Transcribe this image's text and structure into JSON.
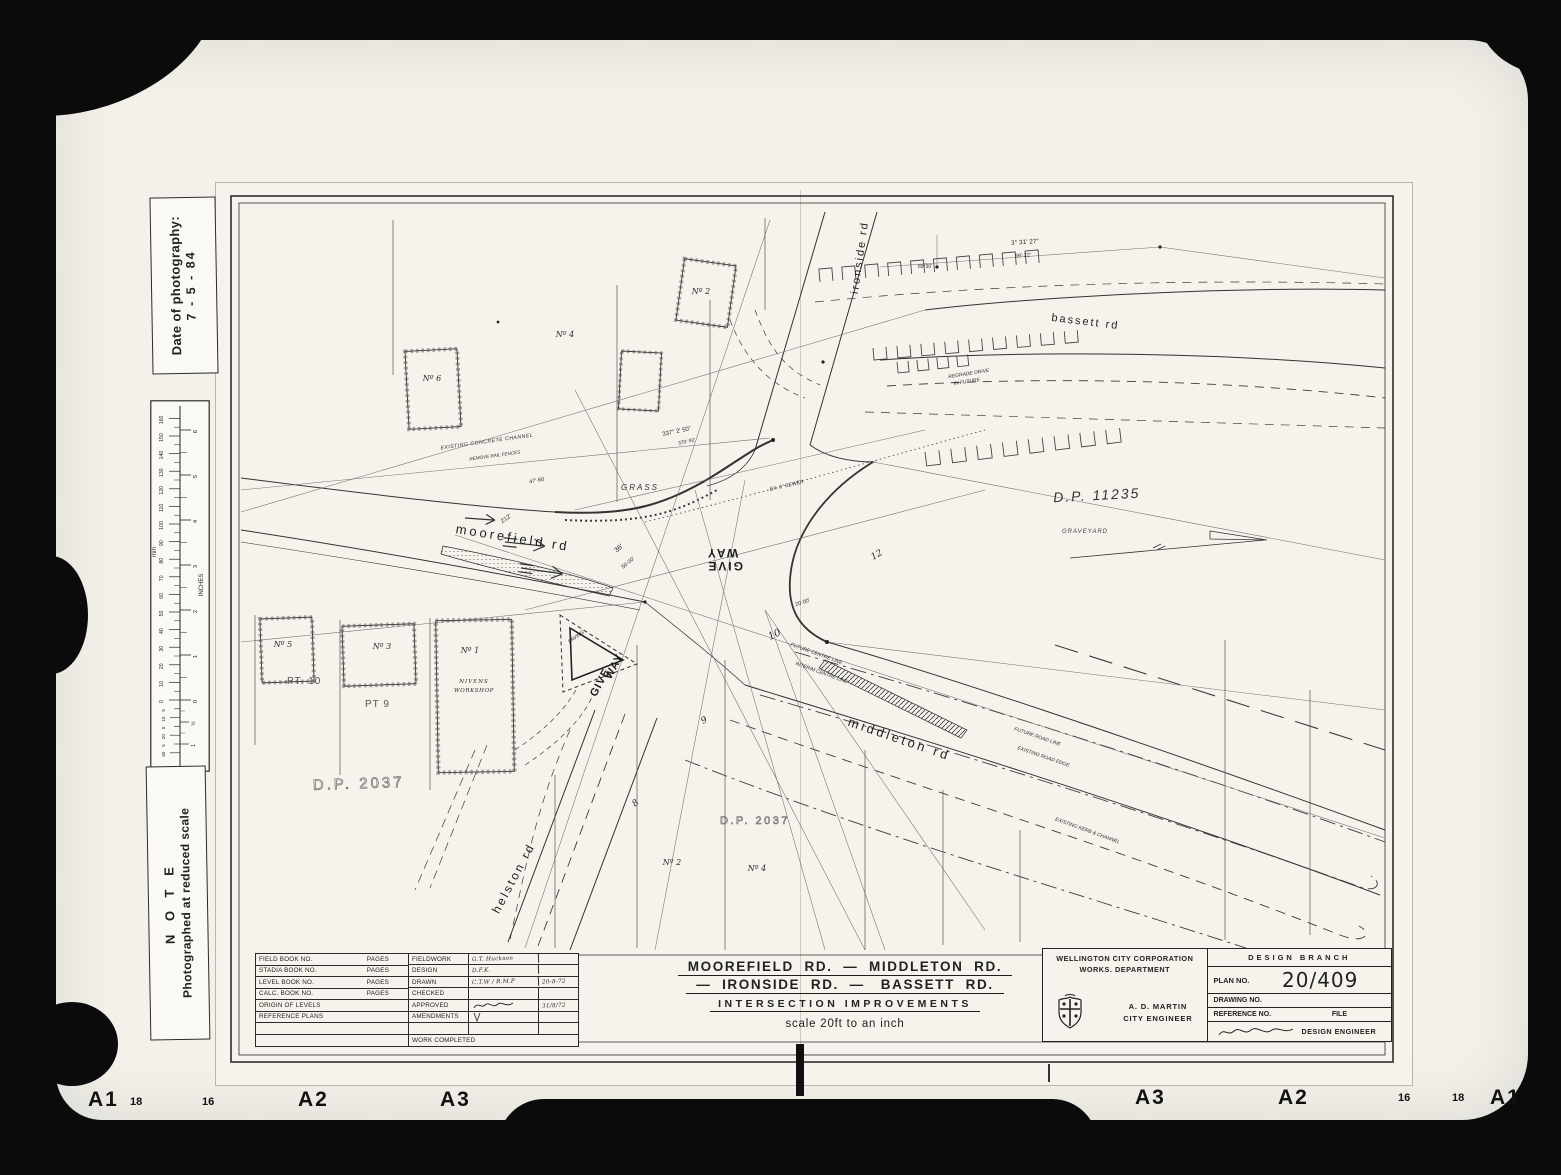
{
  "film": {
    "markers_left": [
      "A1",
      "18",
      "16",
      "A2",
      "A3"
    ],
    "markers_right": [
      "A3",
      "A2",
      "16",
      "18",
      "A1"
    ]
  },
  "side": {
    "date_label": "Date of photography:",
    "date_value": "7 - 5 - 84",
    "note_title": "N O T E",
    "note_text": "Photographed at reduced scale",
    "ruler_mm_label": "mm",
    "ruler_in_label": "INCHES",
    "mm": [
      "160",
      "150",
      "140",
      "130",
      "120",
      "110",
      "100",
      "90",
      "80",
      "70",
      "60",
      "50",
      "40",
      "30",
      "20",
      "10",
      "0"
    ],
    "mm_sub": [
      "5",
      "10",
      "5",
      "20",
      "5",
      "30"
    ],
    "inches": [
      "6",
      "5",
      "4",
      "3",
      "2",
      "1",
      "0"
    ],
    "inches_sub": [
      "½",
      "1"
    ]
  },
  "map": {
    "roads": {
      "moorefield": "moorefield  rd",
      "middleton": "middleton  rd",
      "helston": "helston  rd",
      "ironside": "ironside  rd",
      "bassett": "bassett  rd"
    },
    "areas": {
      "dp11235": "D.P. 11235",
      "dp2037_left": "D.P. 2037",
      "dp2037_mid": "D.P. 2037",
      "grass": "GRASS",
      "graveyard": "GRAVEYARD"
    },
    "lots": {
      "no1": "Nº 1",
      "no2_top": "Nº 2",
      "no3": "Nº 3",
      "no4_top": "Nº 4",
      "no5": "Nº 5",
      "no6": "Nº 6",
      "no2_bot": "Nº 2",
      "no4_bot": "Nº 4",
      "pt10": "PT. 10",
      "pt9": "PT 9",
      "n8": "8",
      "n9": "9",
      "n10": "10",
      "n12": "12",
      "workshop1": "NIVENS",
      "workshop2": "WORKSHOP"
    },
    "texts": {
      "give_word": "GIVE",
      "way_word": "WAY",
      "paving": "PAVING",
      "concrete_channel": "EXISTING CONCRETE CHANNEL",
      "remove_fences": "REMOVE RAIL FENCES",
      "regrade1": "REGRADE DRIVE",
      "regrade2": "IN FUTURE",
      "future_road": "FUTURE ROAD LINE",
      "existing_edge": "EXISTING ROAD EDGE",
      "existing_kerb": "EXISTING KERB & CHANNEL",
      "interim_centre": "INTERIM CENTRE LINE",
      "future_centre": "FUTURE CENTRE LINE",
      "sewer": "EX. 6\" SEWER",
      "angle_top": "3° 31' 27\"",
      "dist_top": "99'·22'",
      "angle_junction": "89°30'",
      "angle_337": "337° 2' 50\"",
      "dist_337": "370'·92'",
      "d36": "36'",
      "d50": "50·00'",
      "d20": "20·00'",
      "d47": "47'·60",
      "d212": "212'"
    }
  },
  "title": {
    "line1": "MOOREFIELD  RD.  —  MIDDLETON  RD.",
    "line2": "—  IRONSIDE  RD.  —   BASSETT  RD.",
    "line3": "INTERSECTION      IMPROVEMENTS",
    "scale": "scale   20ft  to an inch"
  },
  "table": {
    "pages_label": "PAGES",
    "rows_left": [
      {
        "label": "FIELD BOOK NO."
      },
      {
        "label": "STADIA BOOK NO."
      },
      {
        "label": "LEVEL BOOK NO."
      },
      {
        "label": "CALC. BOOK NO."
      },
      {
        "label": "ORIGIN OF LEVELS"
      },
      {
        "label": "REFERENCE PLANS"
      }
    ],
    "rows_right": [
      {
        "label": "FIELDWORK",
        "value": "G.T. Huckson",
        "date": ""
      },
      {
        "label": "DESIGN",
        "value": "D.F.K.",
        "date": ""
      },
      {
        "label": "DRAWN",
        "value": "C.T.W / R.M.P",
        "date": "20-8-72"
      },
      {
        "label": "CHECKED",
        "value": "",
        "date": ""
      },
      {
        "label": "APPROVED",
        "value": "",
        "date": "31/8/72"
      },
      {
        "label": "AMENDMENTS",
        "value": "",
        "date": ""
      }
    ],
    "work_completed": "WORK COMPLETED"
  },
  "agency": {
    "org1": "WELLINGTON CITY CORPORATION",
    "org2": "WORKS.  DEPARTMENT",
    "engineer_name": "A. D. MARTIN",
    "engineer_title": "CITY ENGINEER",
    "branch": "DESIGN   BRANCH",
    "plan_no_label": "PLAN NO.",
    "plan_no": "20/409",
    "drawing_no_label": "DRAWING NO.",
    "reference_label": "REFERENCE NO.",
    "file_label": "FILE",
    "design_engineer": "DESIGN ENGINEER"
  }
}
